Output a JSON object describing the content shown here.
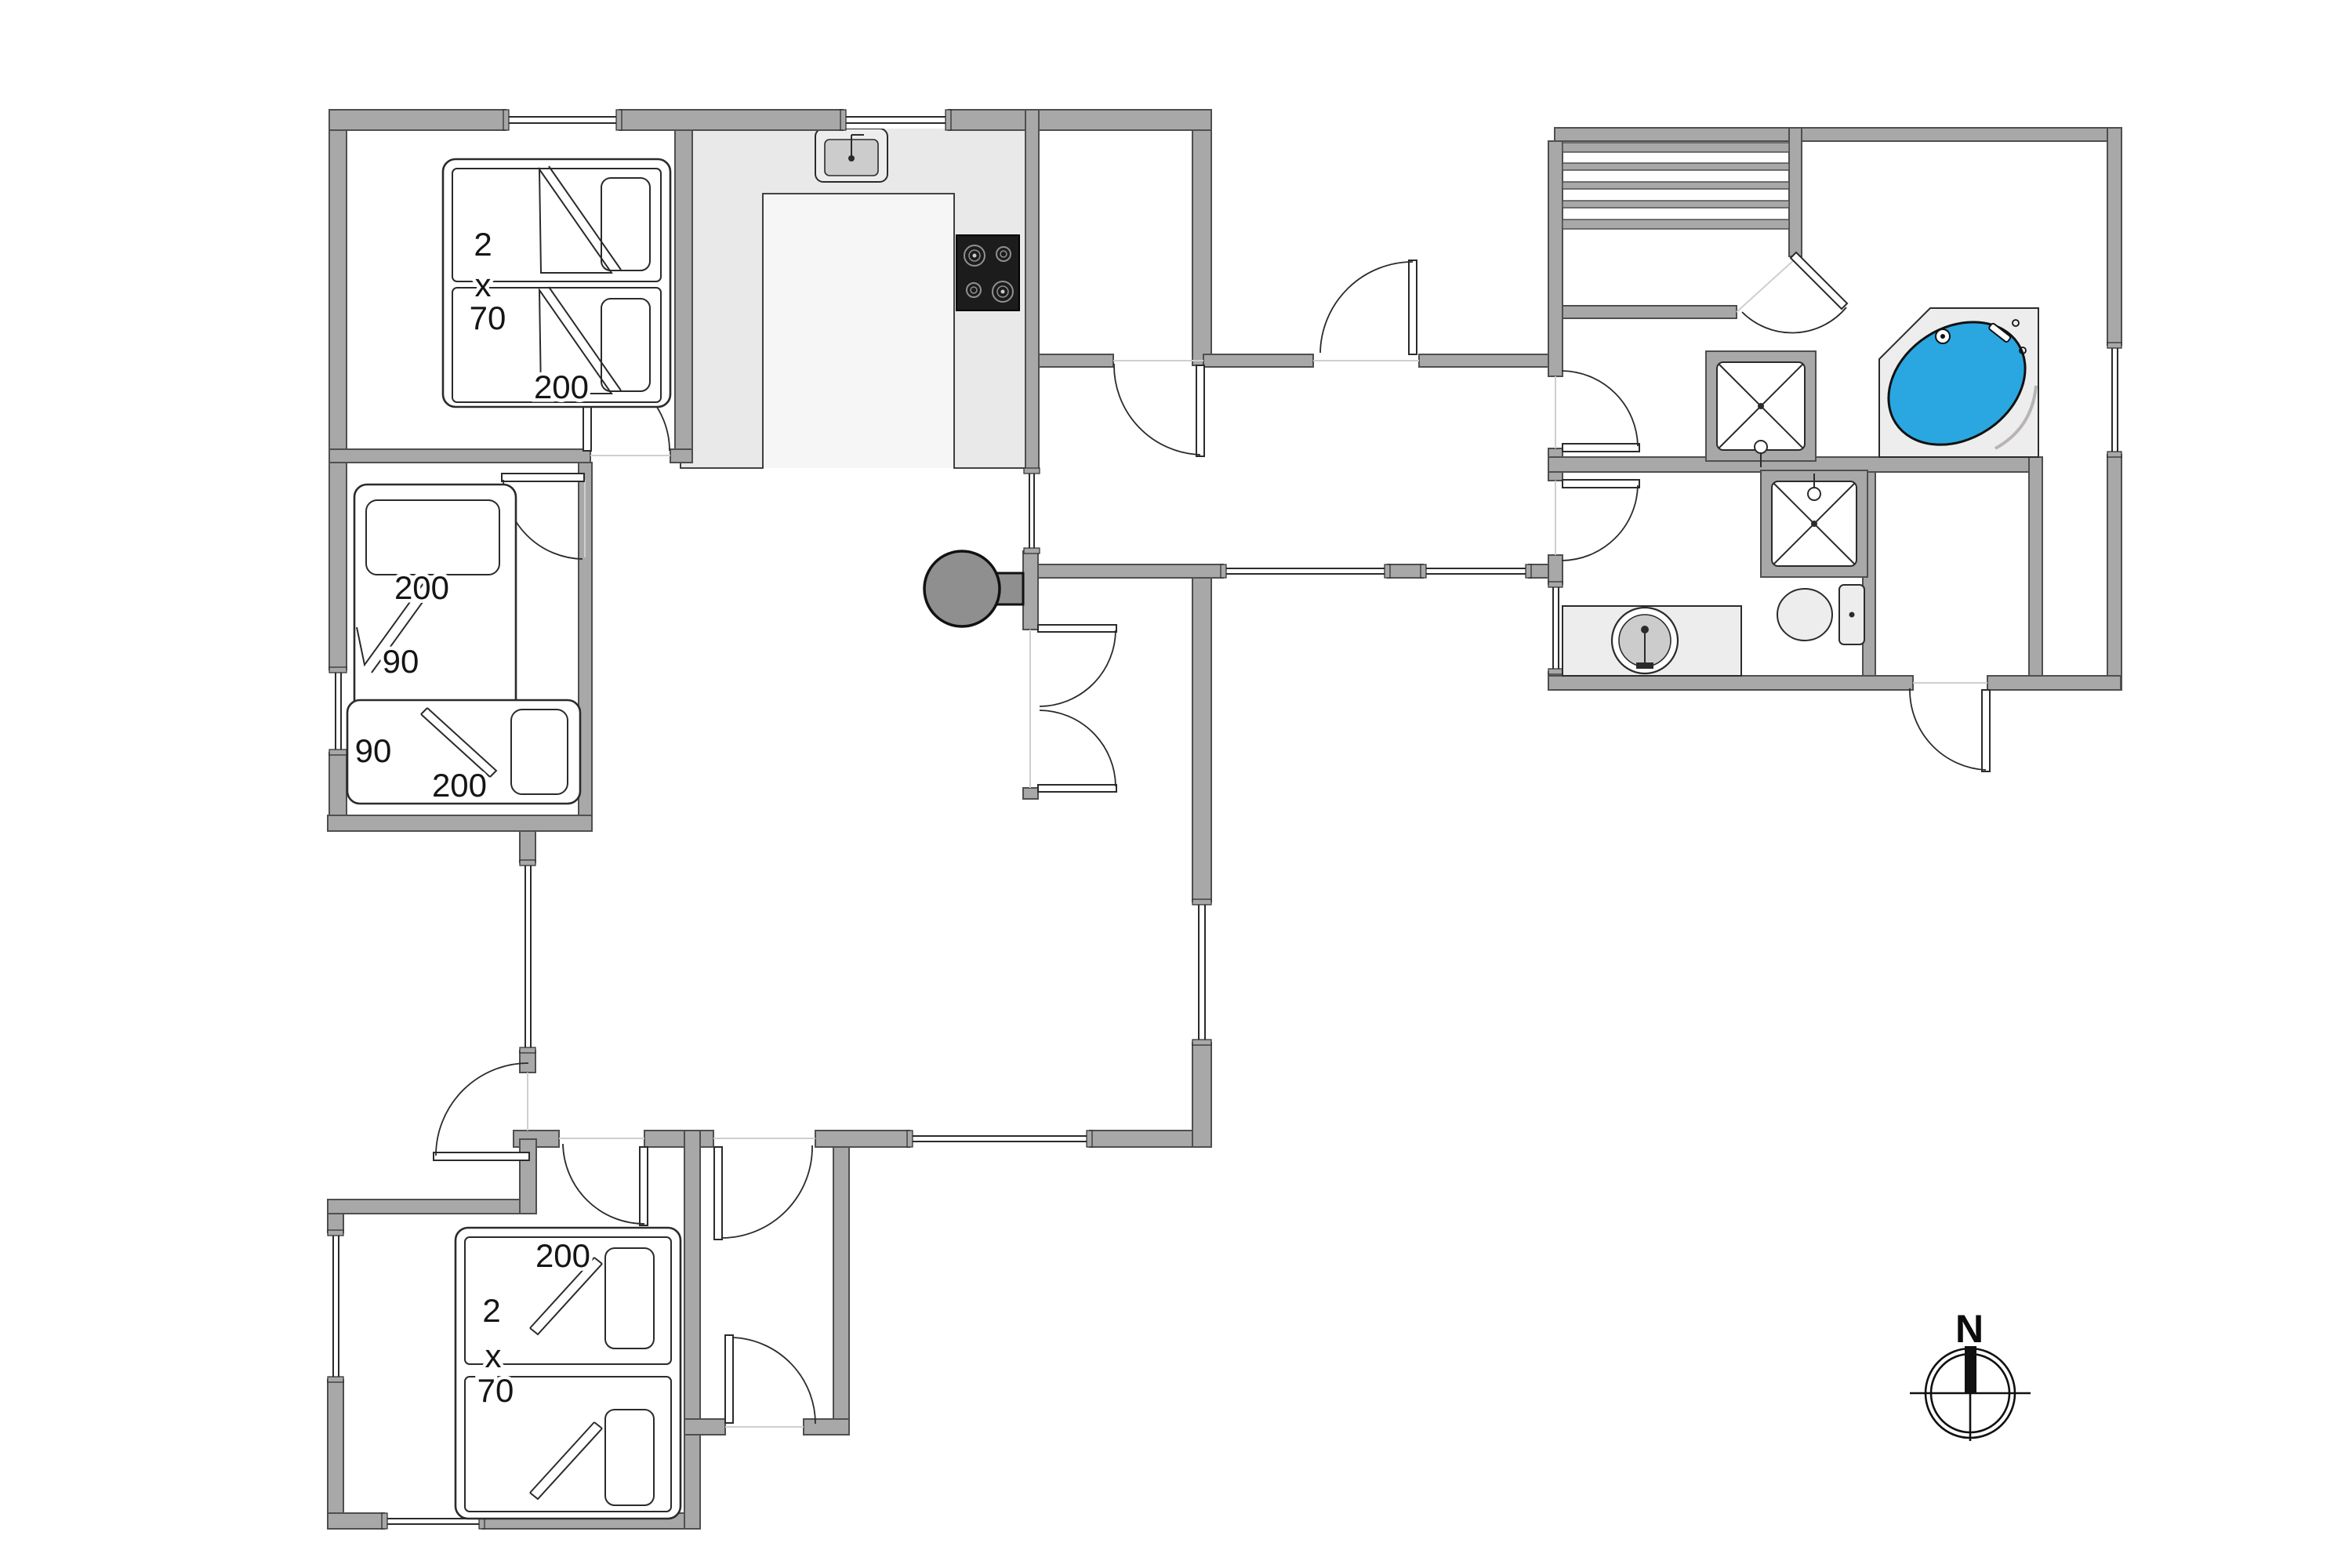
{
  "document": {
    "type": "floor-plan",
    "orientation_label": "N"
  },
  "colors": {
    "wall": "#a8a8a8",
    "wall_edge": "#4f4f4f",
    "line": "#2b2b2b",
    "counter": "#e9e9e9",
    "kitchen_floor": "#f6f6f6",
    "fixture": "#ededed",
    "fixture_inner": "#cccccc",
    "tub": "#2aa7e0",
    "cooktop": "#1c1c1c",
    "burner": "#909090",
    "stove": "#8f8f8f",
    "window_line": "#2b2b2b",
    "threshold": "#cfcfcf",
    "label": "#151515"
  },
  "labels": {
    "bedroom_nw": {
      "qty": "2",
      "times": "x",
      "width": "70",
      "length": "200"
    },
    "bedroom_w": {
      "bed1_length": "200",
      "bed1_width": "90",
      "bed2_width": "90",
      "bed2_length": "200"
    },
    "bedroom_sw": {
      "length": "200",
      "qty": "2",
      "times": "x",
      "width": "70"
    },
    "compass": {
      "north": "N"
    }
  },
  "fixtures": {
    "kitchen_sink": "sink-icon",
    "cooktop": "cooktop-icon",
    "wood_stove": "wood-stove-icon",
    "sauna_benches": "sauna-bench-icon",
    "shower_spa_room": "shower-icon",
    "shower_bathroom": "shower-icon",
    "corner_bathtub": "spa-bathtub-icon",
    "toilet": "toilet-icon",
    "washbasin": "washbasin-icon",
    "compass_rose": "compass-rose-icon"
  }
}
